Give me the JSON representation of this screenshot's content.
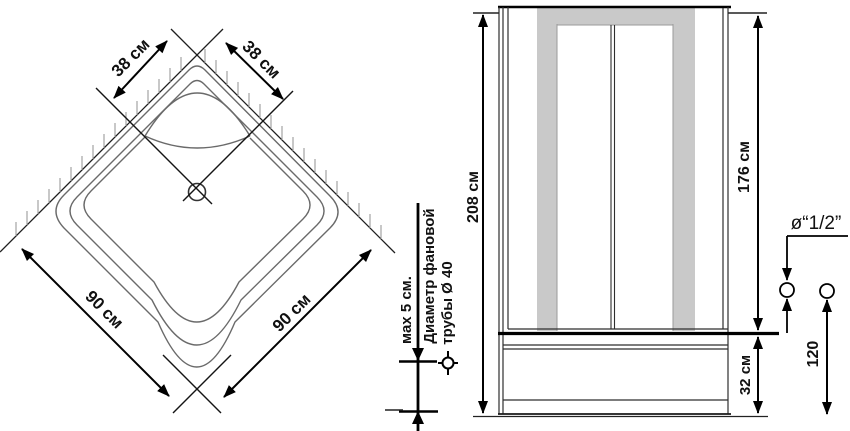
{
  "drawing": {
    "top_view": {
      "dim_back_left": "38 см",
      "dim_back_right": "38 см",
      "dim_front_left": "90 см",
      "dim_front_right": "90 см"
    },
    "drain_note": {
      "max_height": "мах 5 см.",
      "pipe_label_line1": "Диаметр фановой",
      "pipe_label_line2": "трубы Ø 40"
    },
    "front_view": {
      "overall_height": "208 см",
      "door_height": "176 см",
      "tray_height": "32 см"
    },
    "connection": {
      "fitting_size": "ø“1/2”",
      "fitting_height": "120"
    },
    "colors": {
      "panel_gray": "#c9c9c9",
      "line": "#1a1a1a",
      "contour": "#6a6a6a",
      "hatch": "#9a9a9a"
    }
  }
}
